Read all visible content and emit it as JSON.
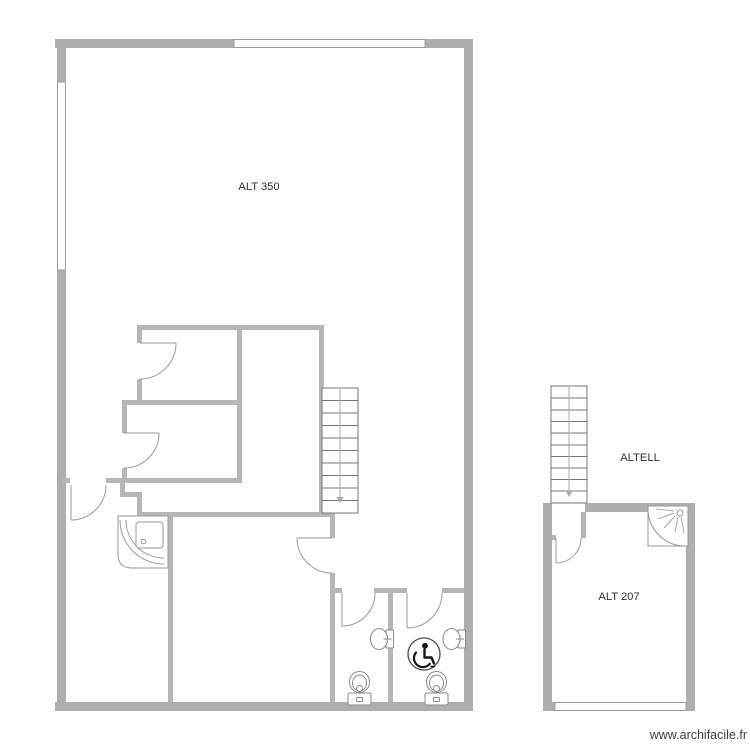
{
  "plan": {
    "title": "floor-plan",
    "rooms": [
      {
        "id": "main-hall",
        "label": "ALT 350"
      },
      {
        "id": "annex-upper",
        "label": "ALTELL"
      },
      {
        "id": "annex-room",
        "label": "ALT 207"
      }
    ],
    "watermark": "www.archifacile.fr",
    "colors": {
      "outer_wall": "#aeaeae",
      "inner_wall": "#b6b6b6",
      "window_fill": "#ffffff",
      "fixture_line": "#9a9a9a",
      "stair_line": "#777777",
      "icon_black": "#151515",
      "label_text": "#2e2e2e",
      "watermark_text": "#3c3c3c"
    },
    "icons": {
      "stairs": "stairs-icon",
      "door": "door-swing-icon",
      "window": "window-icon",
      "toilet": "toilet-icon",
      "sink": "sink-icon",
      "corner_shower": "corner-shower-icon",
      "shower_cabin": "shower-cabin-icon",
      "accessible": "wheelchair-accessible-icon",
      "down_arrow": "stair-direction-arrow-icon"
    }
  }
}
